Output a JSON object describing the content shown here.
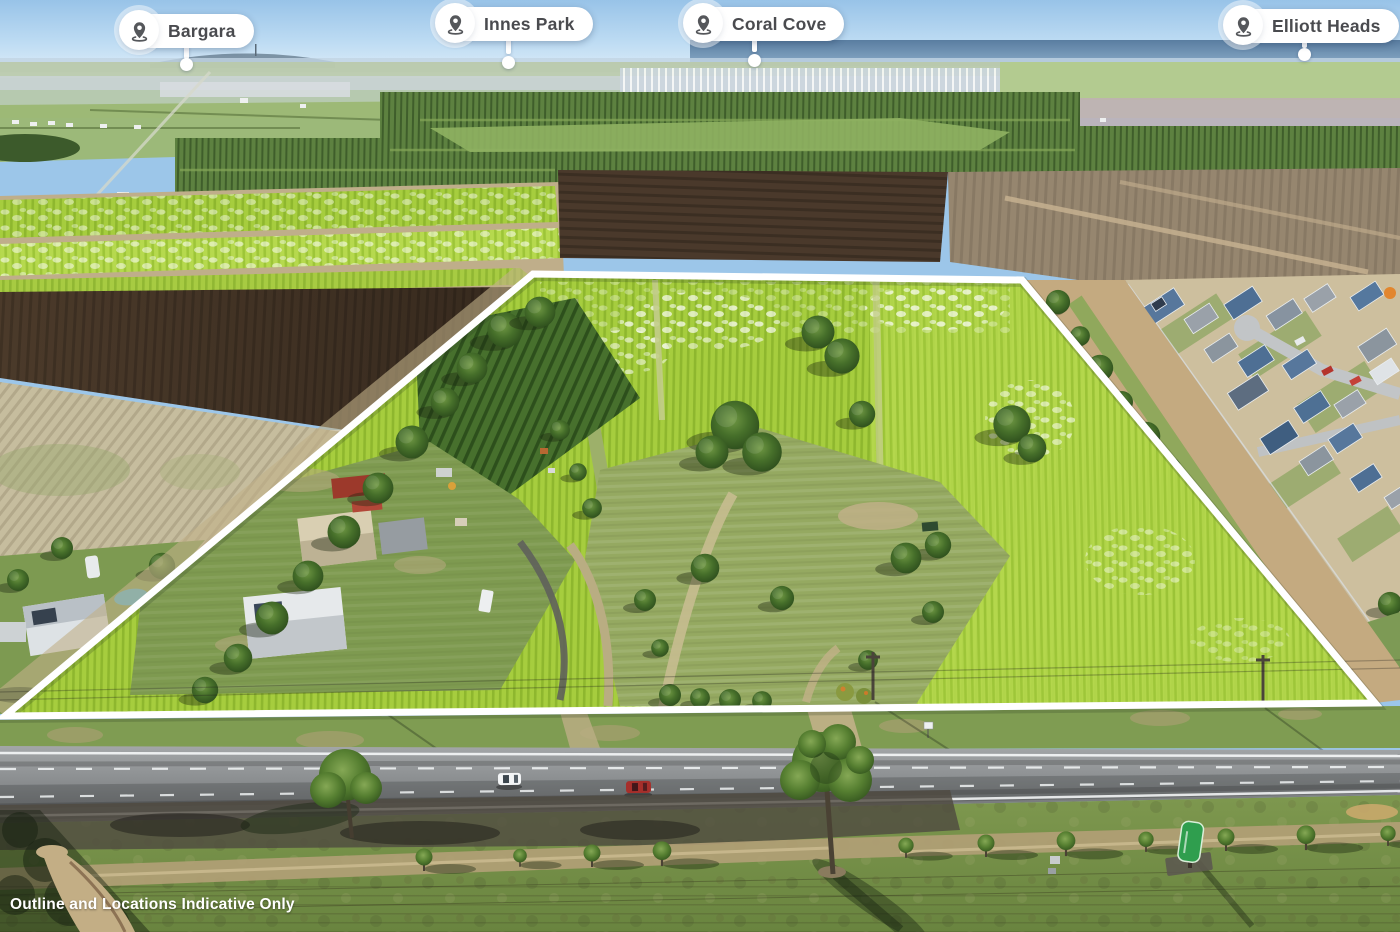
{
  "overlay": {
    "pills": [
      {
        "label": "Bargara"
      },
      {
        "label": "Innes Park"
      },
      {
        "label": "Coral Cove"
      },
      {
        "label": "Elliott Heads"
      }
    ],
    "disclaimer": "Outline and Locations Indicative Only",
    "colors": {
      "boundary_outline": "#ffffff",
      "pill_background": "#ffffff",
      "pill_text": "#4a4b4f",
      "pin_icon": "#55575b"
    }
  },
  "scene": {
    "colors": {
      "sky": "#98c3e8",
      "ocean": "#54789c",
      "cane_field": "#a6cd3e",
      "plowed_soil": "#433426",
      "dry_paddock": "#c6bd9e",
      "road_asphalt": "#8b8e90",
      "grass_verge": "#7f9c52",
      "tree_green": "#2c4c1c",
      "estate_roof_blue": "#4e6f94"
    }
  }
}
